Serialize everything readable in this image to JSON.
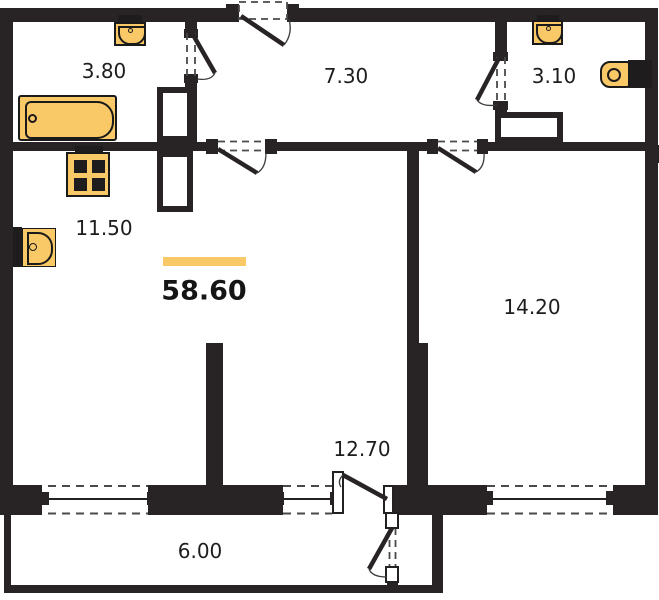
{
  "plan": {
    "title": "apartment-floor-plan",
    "total_area": {
      "value": "58.60",
      "accent_color": "#f9c967"
    },
    "rooms": [
      {
        "id": "bathroom-1",
        "area": "3.80"
      },
      {
        "id": "hallway",
        "area": "7.30"
      },
      {
        "id": "bathroom-2",
        "area": "3.10"
      },
      {
        "id": "kitchen",
        "area": "11.50"
      },
      {
        "id": "bedroom",
        "area": "14.20"
      },
      {
        "id": "living-room",
        "area": "12.70"
      },
      {
        "id": "balcony",
        "area": "6.00"
      }
    ],
    "fixtures": [
      {
        "id": "wash-basin",
        "room": "bathroom-1"
      },
      {
        "id": "bathtub",
        "room": "bathroom-1"
      },
      {
        "id": "stove",
        "room": "kitchen"
      },
      {
        "id": "kitchen-sink",
        "room": "kitchen"
      },
      {
        "id": "wash-basin",
        "room": "bathroom-2"
      },
      {
        "id": "toilet",
        "room": "bathroom-2"
      }
    ],
    "colors": {
      "wall": "#282324",
      "fixture_fill": "#f9c967",
      "background": "#ffffff",
      "text": "#1d1d1d"
    }
  }
}
